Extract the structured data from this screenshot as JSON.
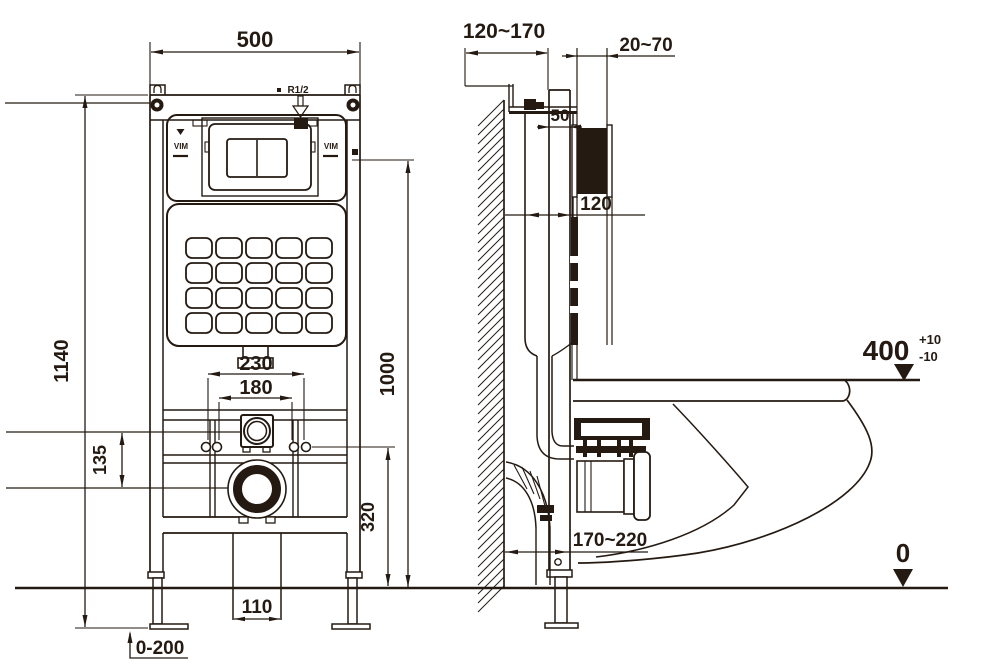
{
  "front_view": {
    "dim_width": "500",
    "dim_height": "1140",
    "dim_flush_height": "1000",
    "dim_bolt_outer": "230",
    "dim_bolt_inner": "180",
    "dim_inlet_offset": "135",
    "dim_drain_height": "320",
    "dim_drain_gap": "110",
    "dim_feet_range": "0-200",
    "inlet_label": "R1/2",
    "brand_left": "VIM",
    "brand_right": "VIM"
  },
  "side_view": {
    "dim_depth_range": "120~170",
    "dim_finish_wall_range": "20~70",
    "dim_profile_depth": "50",
    "dim_cistern_depth": "120",
    "dim_seat_height": "400",
    "dim_seat_tol_plus": "+10",
    "dim_seat_tol_minus": "-10",
    "dim_outlet_range": "170~220",
    "dim_floor_datum": "0"
  },
  "colors": {
    "line": "#241a12",
    "background": "#ffffff"
  }
}
